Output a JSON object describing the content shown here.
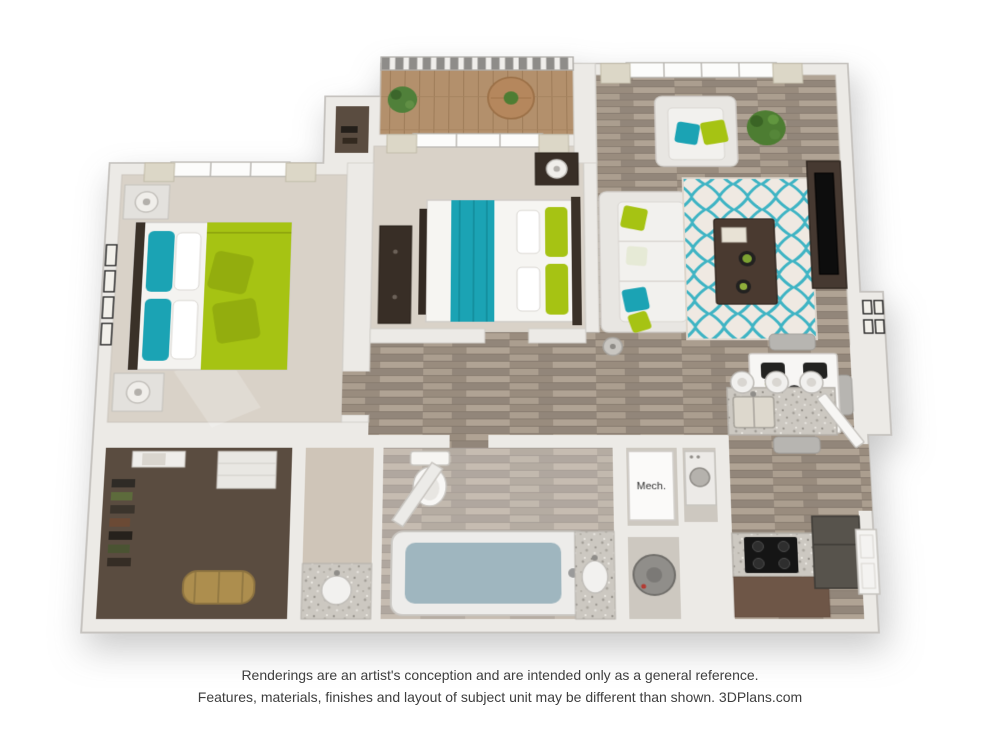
{
  "labels": {
    "mech": "Mech."
  },
  "disclaimer": {
    "line1": "Renderings are an artist's conception and are intended only as a general reference.",
    "line2": "Features, materials, finishes and layout of subject unit may be different than shown. 3DPlans.com"
  },
  "colors": {
    "accent_teal": "#1ba3b4",
    "accent_teal_light": "#3fb4c4",
    "accent_lime": "#a6c313",
    "accent_lime_dark": "#93ad0e",
    "wall": "#efedea",
    "carpet": "#d9d2c8",
    "wood_floor": "#a29488",
    "balcony_wood": "#b3906c",
    "granite": "#ccc8c1",
    "cabinet_brown": "#6e5647",
    "dark_furniture": "#3a3128",
    "water": "#9fb6bf",
    "closet_floor": "#5a4c40",
    "bench_gold": "#ad8e4e"
  }
}
